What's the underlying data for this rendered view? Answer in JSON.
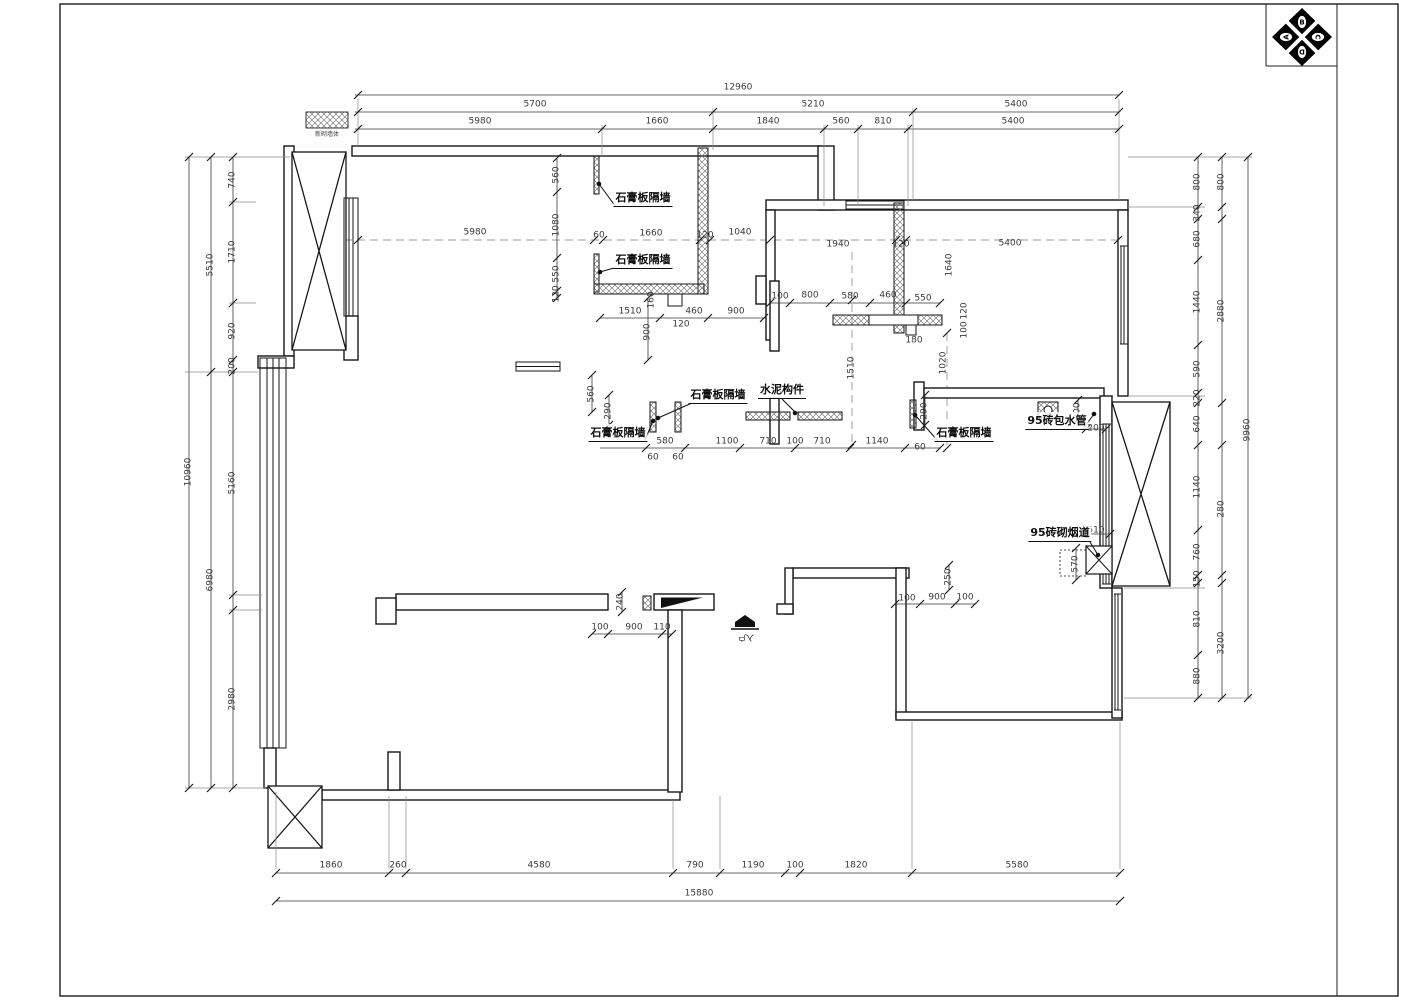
{
  "logo": {
    "letters": [
      "A",
      "B",
      "C",
      "D"
    ]
  },
  "legend": {
    "label": "新砌墙体"
  },
  "annotations": {
    "gypsum_wall": "石膏板隔墙",
    "cement_member": "水泥构件",
    "brick_pipe_wrap": "95砖包水管",
    "brick_flue": "95砖砌烟道",
    "entry": "入户"
  },
  "dims": {
    "top": {
      "total": "12960",
      "row2": [
        "5700",
        "5210",
        "5400"
      ],
      "row3": [
        "5980",
        "1660",
        "1840",
        "560",
        "810",
        "5400"
      ]
    },
    "left": {
      "outer": "10960",
      "mid": [
        "5510",
        "6980"
      ],
      "inner": [
        "740",
        "1710",
        "920",
        "200",
        "5160",
        "2980"
      ]
    },
    "right": {
      "outer": "9960",
      "mid": [
        "800",
        "2880",
        "280",
        "3200"
      ],
      "inner": [
        "800",
        "340",
        "680",
        "1440",
        "590",
        "220",
        "640",
        "1140",
        "760",
        "150",
        "810",
        "880"
      ]
    },
    "bottom": {
      "total": "15880",
      "row": [
        "1860",
        "260",
        "4580",
        "790",
        "1190",
        "100",
        "1820",
        "5580"
      ]
    },
    "dashed": [
      "5980",
      "60",
      "1660",
      "120",
      "1040",
      "1940",
      "120",
      "5400"
    ],
    "dashed_v": "1640",
    "kitchen_v": [
      "560",
      "1080",
      "550",
      "120"
    ],
    "kitchen_tab": "160",
    "chain_left": [
      "1510",
      "460",
      "900"
    ],
    "chain_left_sub": "120",
    "chain_left_v": "900",
    "chain_right": [
      "100",
      "800",
      "580",
      "460",
      "550"
    ],
    "chain_right_sub": "180",
    "chain_right_v": [
      "120",
      "100",
      "1020",
      "1510"
    ],
    "chain2": [
      "580",
      "1100",
      "710",
      "100",
      "710",
      "1140",
      "60"
    ],
    "chain2_sub": [
      "60",
      "60"
    ],
    "chain2_v": [
      "560",
      "290",
      "290"
    ],
    "pipe": [
      "200",
      "200"
    ],
    "flue": [
      "510",
      "570"
    ],
    "entry_chain": [
      "240",
      "100",
      "900",
      "110"
    ],
    "right_room": [
      "250",
      "100",
      "900",
      "100"
    ]
  }
}
